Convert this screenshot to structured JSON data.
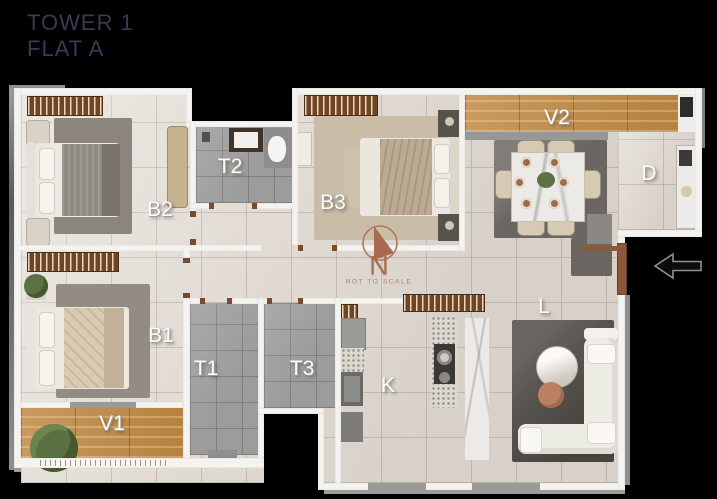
{
  "page": {
    "background": "#000000"
  },
  "header": {
    "title_line1": "TOWER 1",
    "title_line2": "FLAT A",
    "text_color": "#3d3853"
  },
  "plan": {
    "rooms": [
      {
        "id": "b2",
        "label": "B2",
        "type": "bedroom"
      },
      {
        "id": "t2",
        "label": "T2",
        "type": "toilet"
      },
      {
        "id": "b3",
        "label": "B3",
        "type": "bedroom"
      },
      {
        "id": "v2",
        "label": "V2",
        "type": "veranda"
      },
      {
        "id": "d",
        "label": "D",
        "type": "dining"
      },
      {
        "id": "b1",
        "label": "B1",
        "type": "bedroom"
      },
      {
        "id": "t1",
        "label": "T1",
        "type": "toilet"
      },
      {
        "id": "t3",
        "label": "T3",
        "type": "toilet"
      },
      {
        "id": "k",
        "label": "K",
        "type": "kitchen"
      },
      {
        "id": "l",
        "label": "L",
        "type": "living"
      },
      {
        "id": "v1",
        "label": "V1",
        "type": "veranda"
      }
    ],
    "compass": {
      "letter": "N",
      "note": "NOT TO SCALE",
      "color": "#a96a50"
    },
    "entry": {
      "icon": "arrow-left",
      "meaning": "entrance"
    }
  },
  "colors": {
    "wall": "#f4f3f0",
    "tile": "#e2dcd5",
    "bath_tile": "#9c9c9c",
    "wood": "#c3925a",
    "accent": "#a96a50",
    "label": "#fcfcfa"
  }
}
